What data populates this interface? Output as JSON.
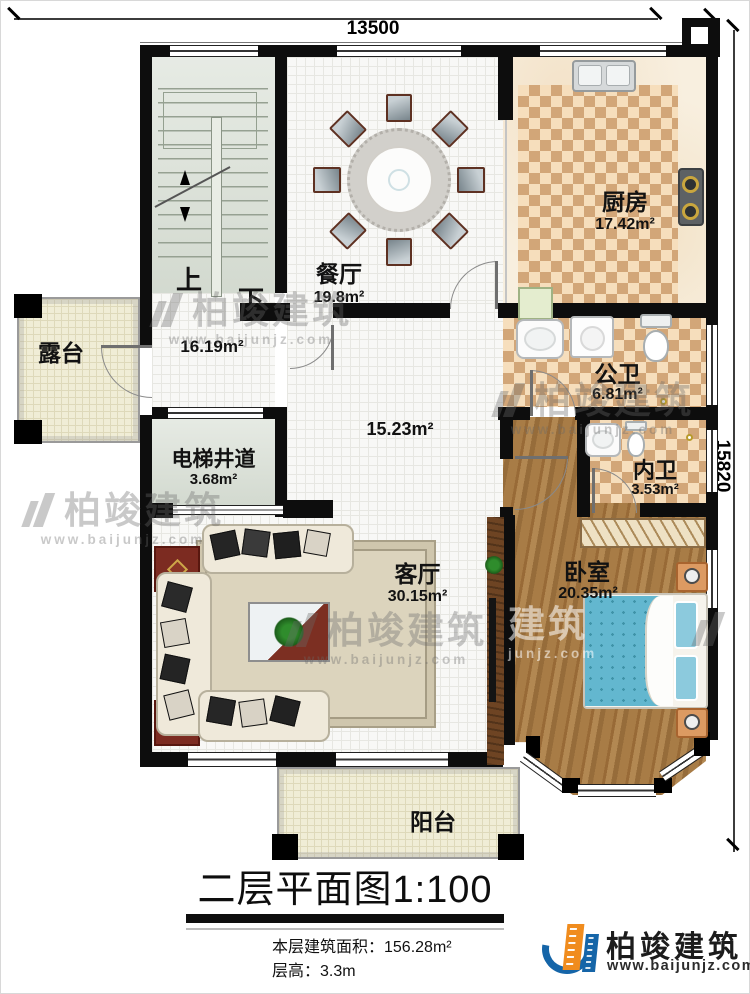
{
  "title": "二层平面图1:100",
  "dimensions": {
    "width_mm": "13500",
    "height_mm": "15820"
  },
  "stats": {
    "floor_area": "本层建筑面积：156.28m²",
    "floor_height": "层高：3.3m"
  },
  "logo": {
    "name": "柏竣建筑",
    "website": "www.baijunjz.com"
  },
  "watermark": {
    "brand": "柏竣建筑",
    "website": "www.baijunjz.com",
    "partial_brand": "建筑",
    "partial_site": "junjz.com"
  },
  "stairs": {
    "up": "上",
    "down": "下"
  },
  "rooms": {
    "dining": {
      "name": "餐厅",
      "area": "19.8m²"
    },
    "kitchen": {
      "name": "厨房",
      "area": "17.42m²"
    },
    "stair_hall": {
      "area": "16.19m²"
    },
    "hall": {
      "area": "15.23m²"
    },
    "elevator": {
      "name": "电梯井道",
      "area": "3.68m²"
    },
    "public_bath": {
      "name": "公卫",
      "area": "6.81m²"
    },
    "inner_bath": {
      "name": "内卫",
      "area": "3.53m²"
    },
    "living": {
      "name": "客厅",
      "area": "30.15m²"
    },
    "bedroom": {
      "name": "卧室",
      "area": "20.35m²"
    },
    "terrace": {
      "name": "露台"
    },
    "balcony": {
      "name": "阳台"
    }
  },
  "colors": {
    "wall": "#0d0d0d",
    "checker_a": "#d2a678",
    "checker_b": "#f6debc",
    "wood": "#a87c46",
    "bed": "#63b7cf",
    "green_floor": "#dee4db",
    "cream_floor": "#f0edd6",
    "logo_blue": "#1565a8",
    "logo_orange": "#f08c1e"
  }
}
